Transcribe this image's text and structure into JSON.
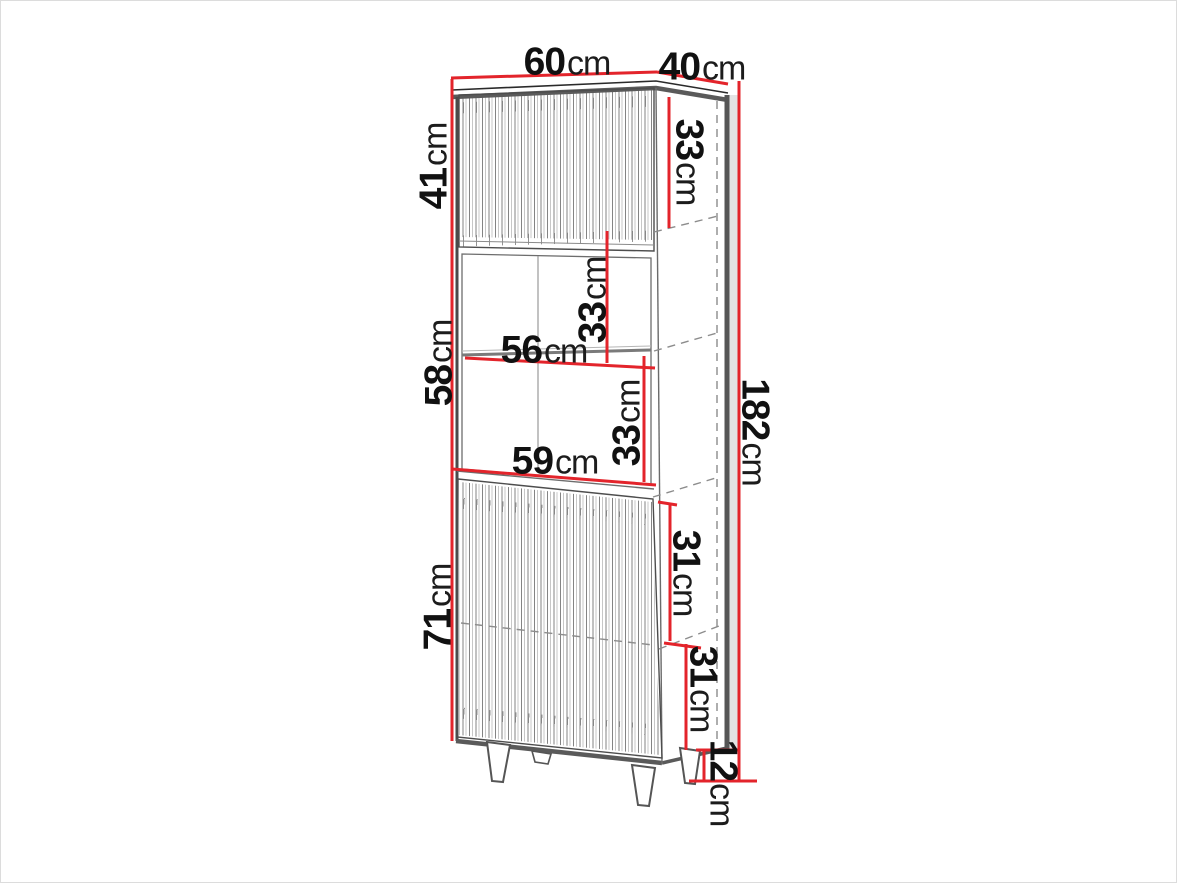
{
  "diagram": {
    "type": "furniture-dimension-diagram",
    "subject": "tall display cabinet with two fluted doors, open middle niche with shelf, and tapered legs",
    "unit": "cm",
    "colors": {
      "dimension_line": "#e3242b",
      "outline": "#2a2a2a",
      "hidden_line": "#8c8c8c",
      "background": "#ffffff"
    },
    "dimensions": {
      "top_width": {
        "value": "60",
        "unit": "cm"
      },
      "top_depth": {
        "value": "40",
        "unit": "cm"
      },
      "upper_door_height": {
        "value": "41",
        "unit": "cm"
      },
      "upper_inner_height": {
        "value": "33",
        "unit": "cm"
      },
      "niche_upper_height": {
        "value": "33",
        "unit": "cm"
      },
      "shelf_width": {
        "value": "56",
        "unit": "cm"
      },
      "niche_total_height": {
        "value": "58",
        "unit": "cm"
      },
      "niche_lower_height": {
        "value": "33",
        "unit": "cm"
      },
      "lower_top_width": {
        "value": "59",
        "unit": "cm"
      },
      "total_height": {
        "value": "182",
        "unit": "cm"
      },
      "lower_door_height": {
        "value": "71",
        "unit": "cm"
      },
      "lower_inner_upper_height": {
        "value": "31",
        "unit": "cm"
      },
      "lower_inner_lower_height": {
        "value": "31",
        "unit": "cm"
      },
      "leg_height": {
        "value": "12",
        "unit": "cm"
      }
    }
  }
}
